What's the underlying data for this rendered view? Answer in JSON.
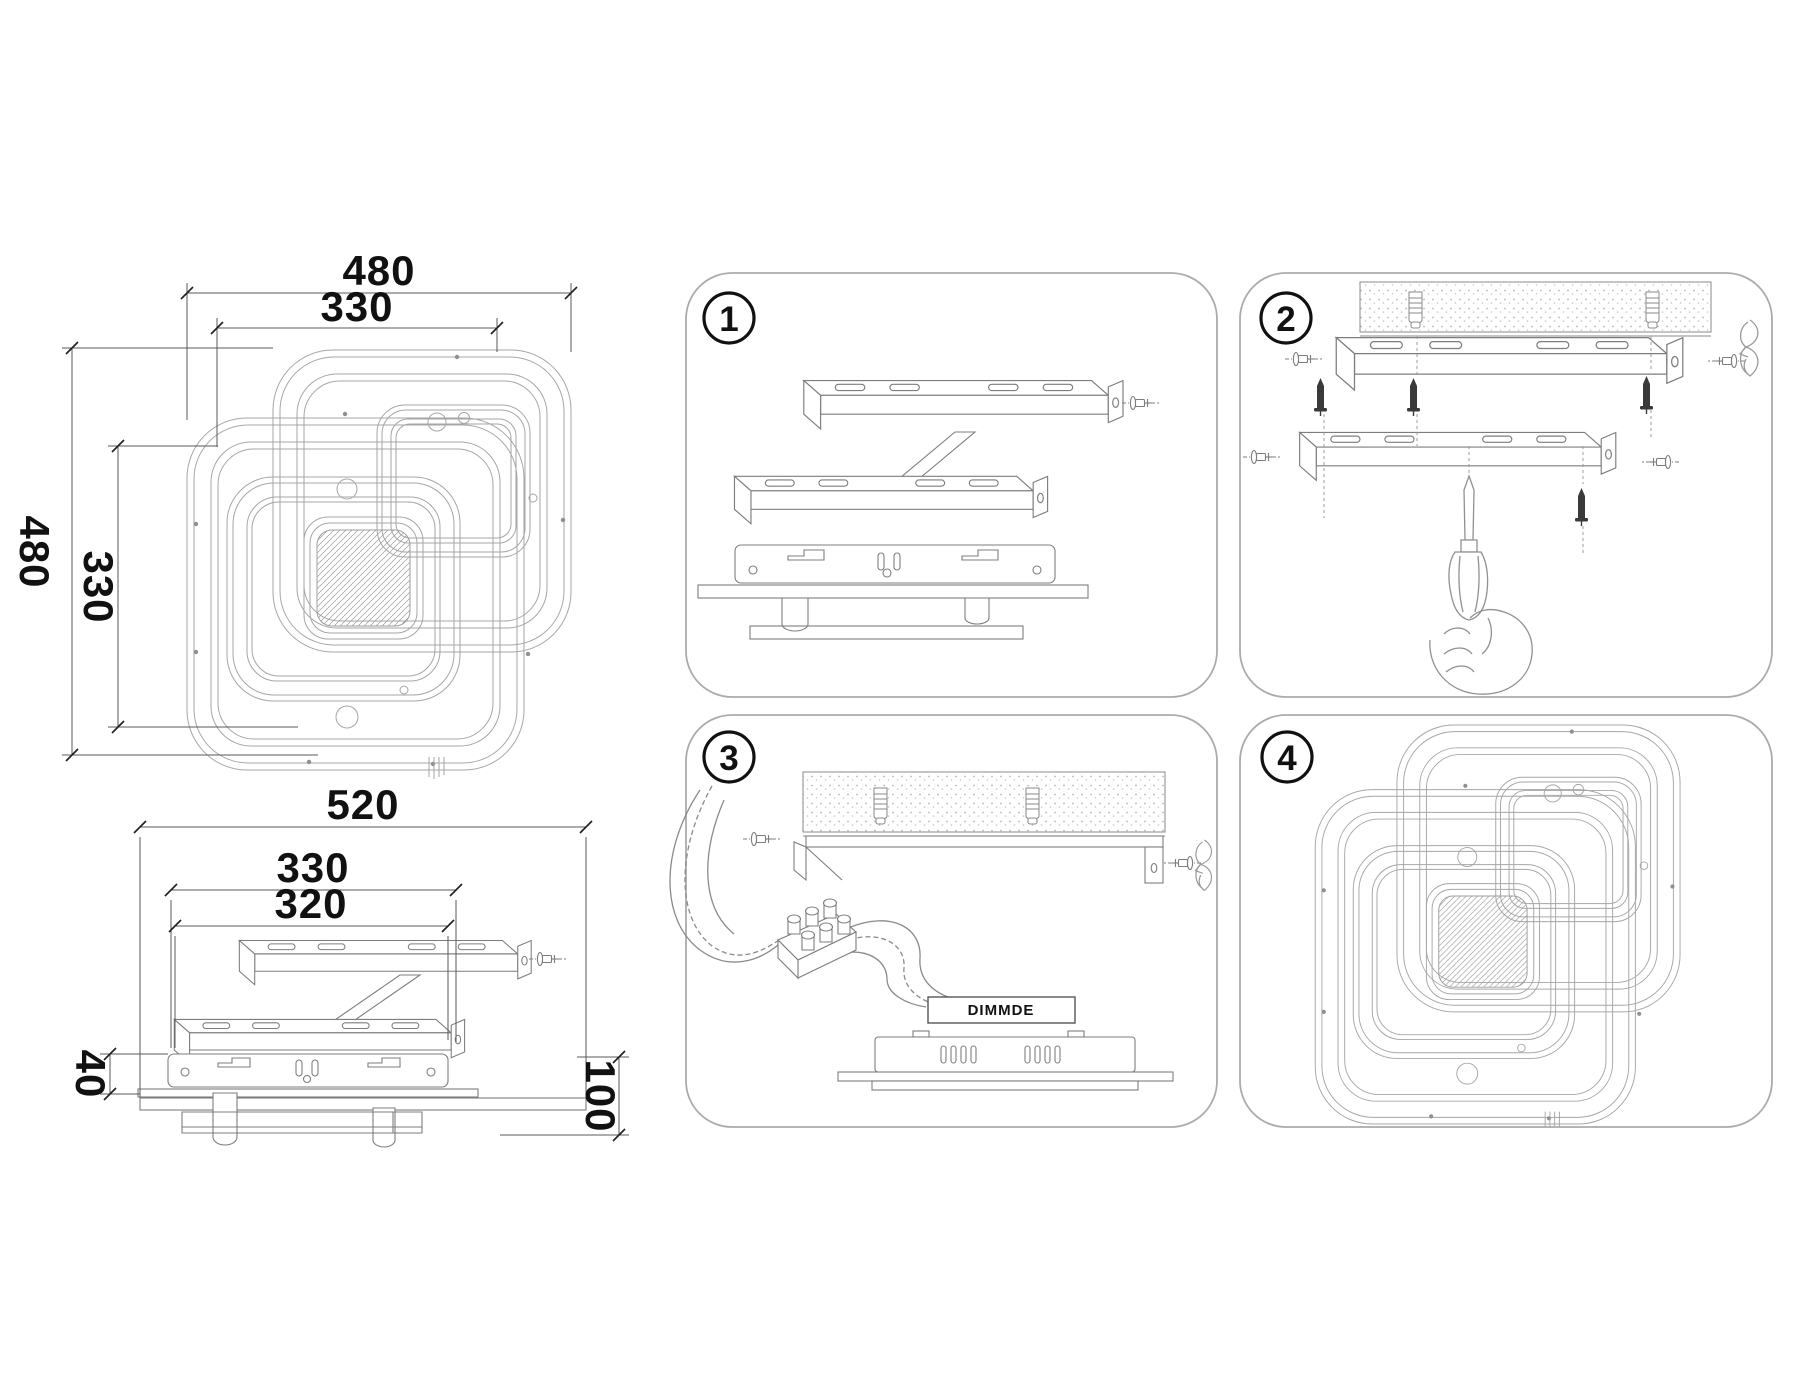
{
  "page": {
    "background": "#ffffff"
  },
  "colors": {
    "panel_border": "#ababab",
    "lamp_line": "#a6a6a6",
    "part_line": "#7d7d7d",
    "dim_line": "#444444",
    "dim_text": "#111111",
    "anchor_fill": "#3a3a3a"
  },
  "plan_view": {
    "width_outer": "480",
    "width_inner": "330",
    "height_outer": "480",
    "height_inner": "330"
  },
  "side_view": {
    "width_total": "520",
    "bracket_width": "330",
    "bracket_inner": "320",
    "base_height": "40",
    "total_height": "100"
  },
  "steps": {
    "one": "1",
    "two": "2",
    "three": "3",
    "four": "4"
  },
  "labels": {
    "driver": "DIMMDE"
  }
}
